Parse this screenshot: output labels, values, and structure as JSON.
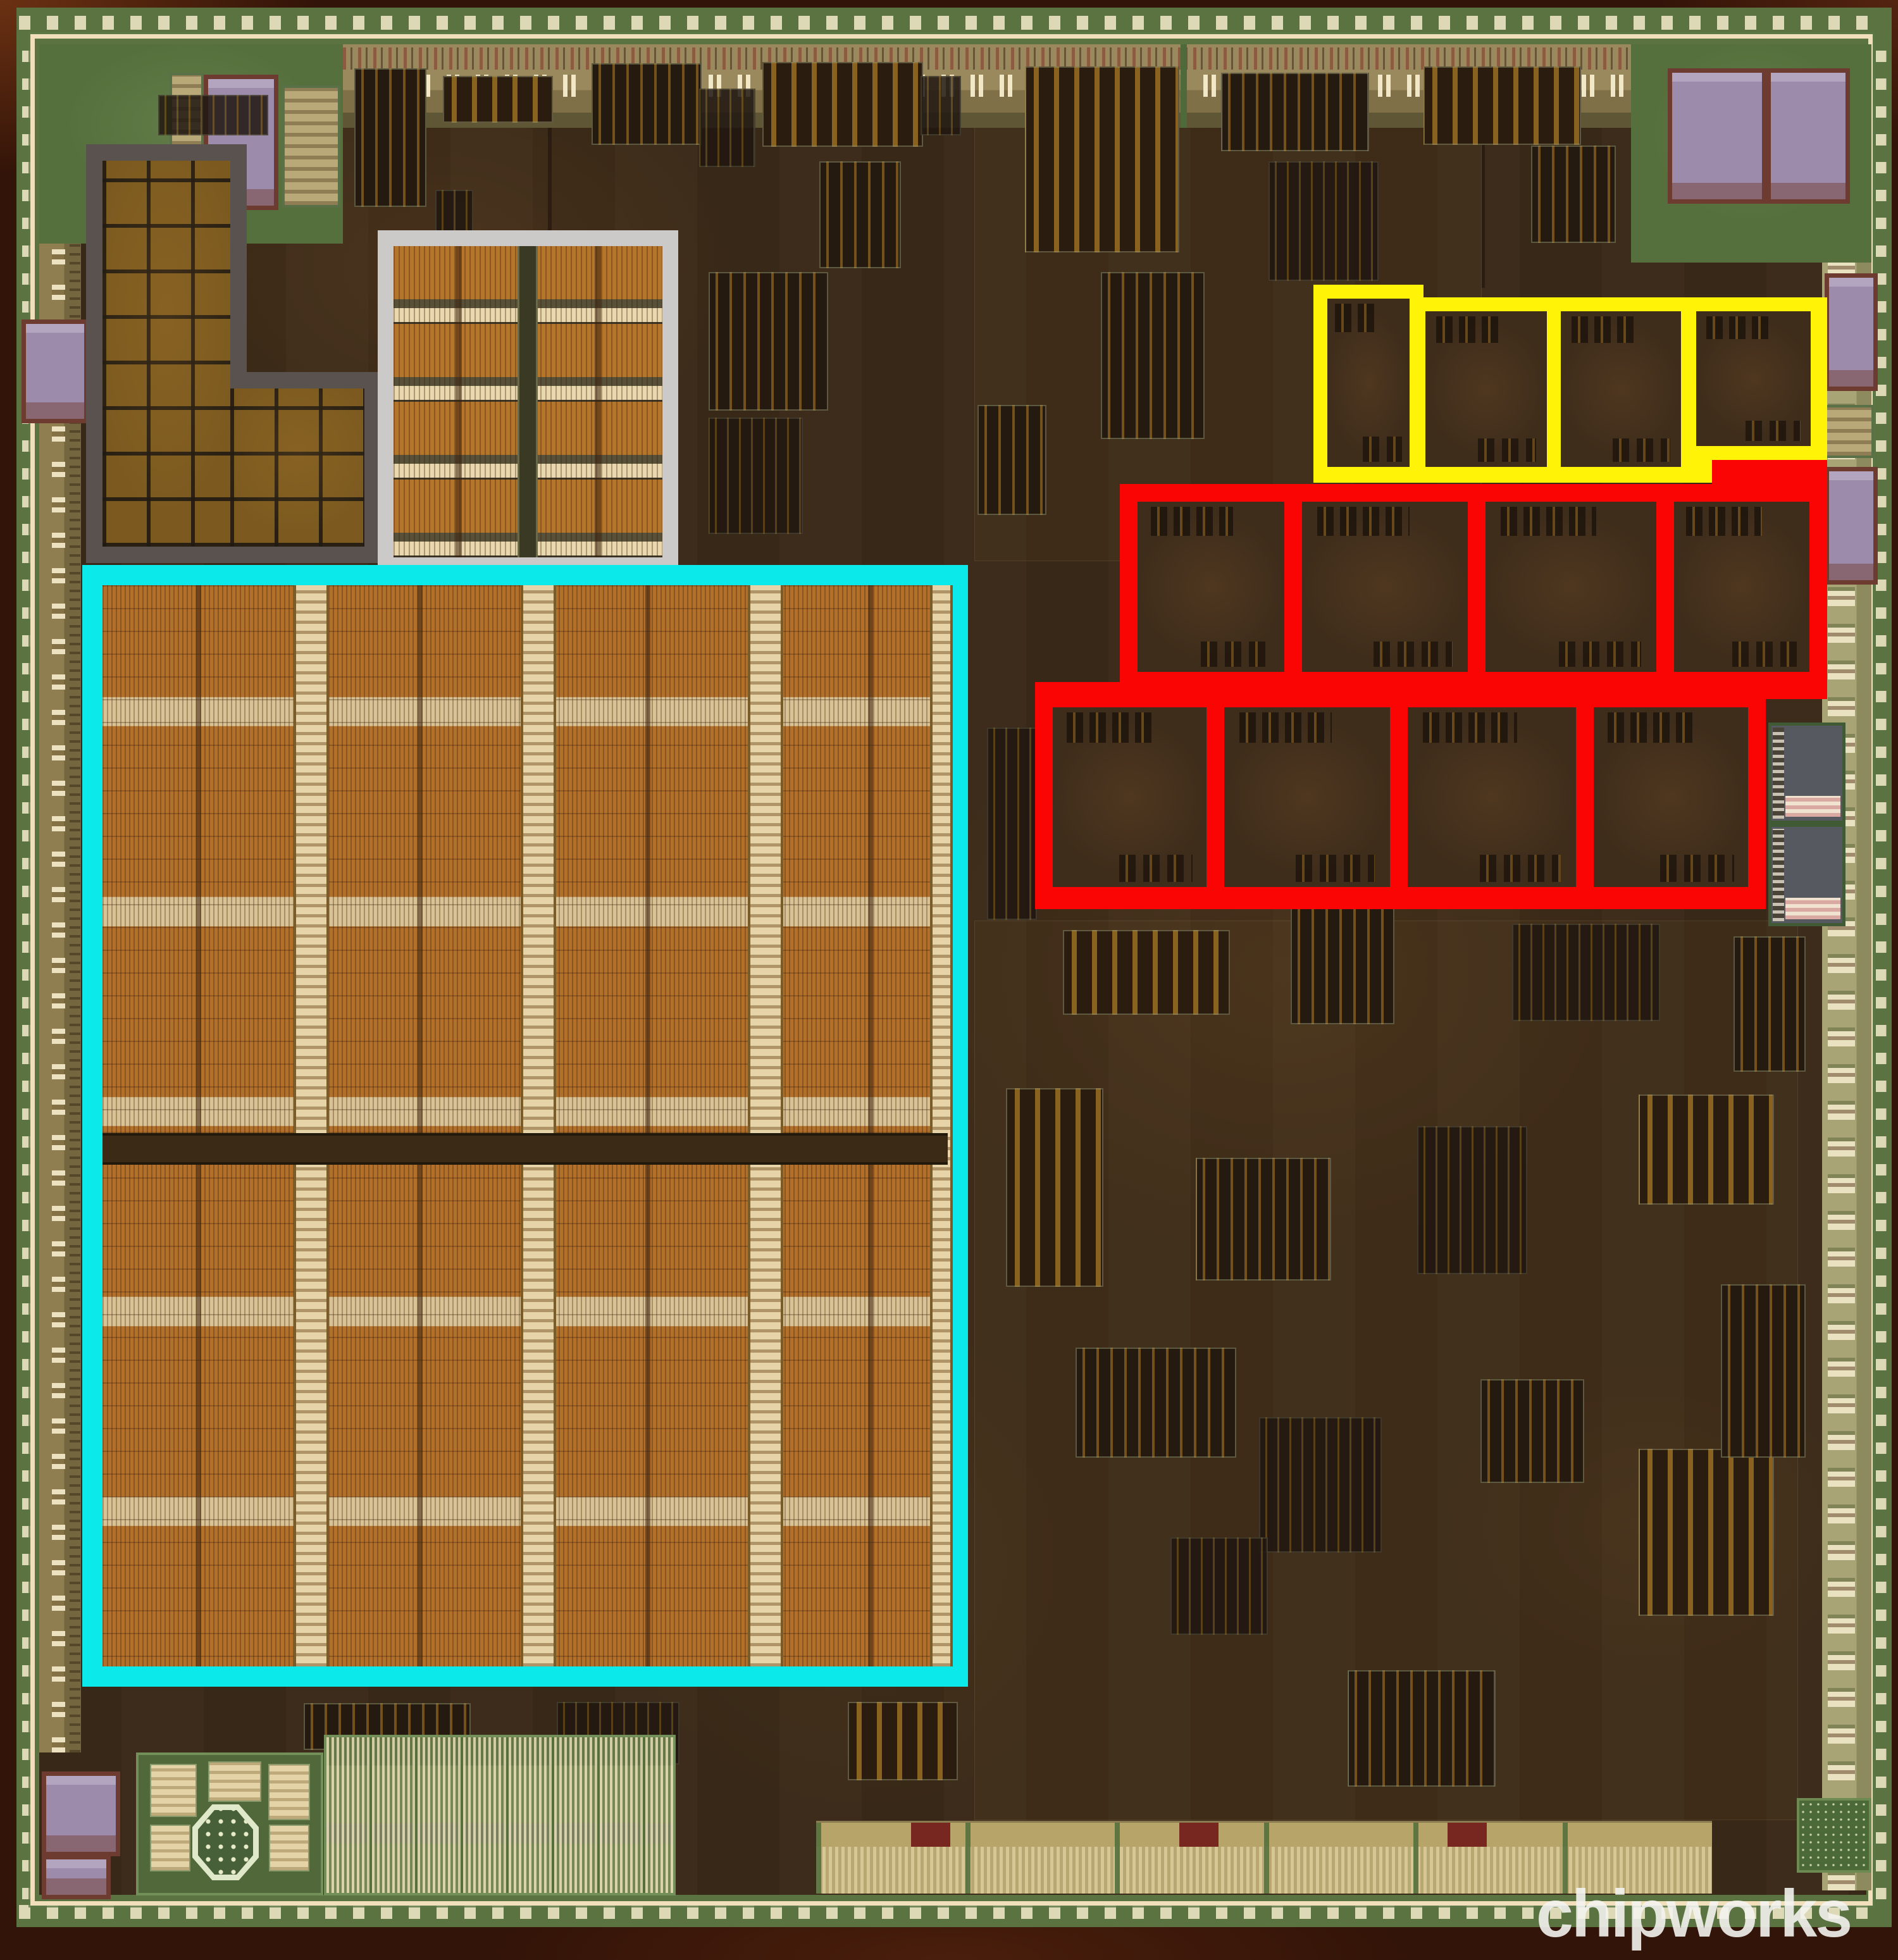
{
  "watermark": {
    "text": "chipworks",
    "color": "#F3F3F0"
  },
  "annotations": {
    "cyan": {
      "name": "large-dram-array-outline",
      "color": "#0BE9EA",
      "regions": 1
    },
    "red": {
      "name": "red-outlined-core-blocks",
      "color": "#FB0404",
      "cells": 8,
      "rows": 2,
      "cells_per_row": 4
    },
    "yellow": {
      "name": "yellow-outlined-core-blocks",
      "color": "#FFF308",
      "cells": 4,
      "rows": 1
    },
    "dark_gray": {
      "name": "dark-gray-memory-tile-region",
      "color": "#59524F"
    },
    "light_gray": {
      "name": "light-gray-memory-macro",
      "color": "#CBCAC8"
    }
  },
  "die_palette": {
    "interior_brown": "#3B2A18",
    "pad_ring_green": "#5B7340",
    "seal_ring_line": "#F0DFBA",
    "memory_orange": "#B2702A",
    "io_band_khaki": "#9A895C",
    "analog_green": "#51683B",
    "pad_purple": "#9D8BAB",
    "edge_wood_brown": "#331408"
  }
}
